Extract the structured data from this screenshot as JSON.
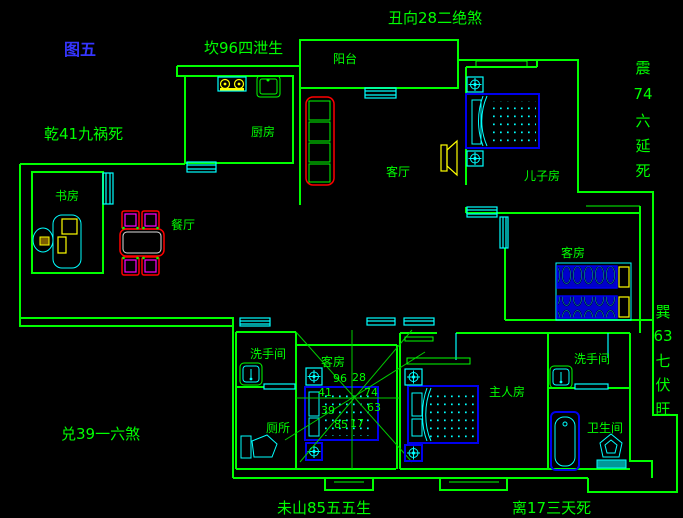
{
  "figure": {
    "label": "图五"
  },
  "palette": {
    "background": "#000000",
    "wall_green": "#00ff00",
    "window_cyan": "#00ffff",
    "furniture_blue": "#0000ee",
    "accent_red": "#ff0000",
    "accent_yellow": "#ffff00",
    "accent_magenta": "#ff00ff",
    "figure_label_blue": "#3535ff"
  },
  "annotations": {
    "north": "坎96四泄生",
    "northeast": "丑向28二绝煞",
    "northwest": "乾41九祸死",
    "west": "兑39一六煞",
    "southwest": "未山85五五生",
    "south": "离17三天死",
    "east_vertical": [
      "震",
      "74",
      "六",
      "延",
      "死"
    ],
    "southeast_vertical": [
      "巽",
      "63",
      "七",
      "伏",
      "旺"
    ]
  },
  "rooms": {
    "balcony": "阳台",
    "kitchen": "厨房",
    "living_room": "客厅",
    "sons_room": "儿子房",
    "study": "书房",
    "dining_room": "餐厅",
    "guest_room_east": "客房",
    "guest_room_center": "客房",
    "washroom_center": "洗手间",
    "toilet_room": "厕所",
    "master_bedroom": "主人房",
    "washroom_east": "洗手间",
    "bathroom": "卫生间"
  },
  "compass": {
    "top_left": "96",
    "top_right": "28",
    "left_upper": "41",
    "right_upper": "74",
    "left_lower": "39",
    "right_lower": "63",
    "bottom_left": "85",
    "bottom_right": "17"
  }
}
